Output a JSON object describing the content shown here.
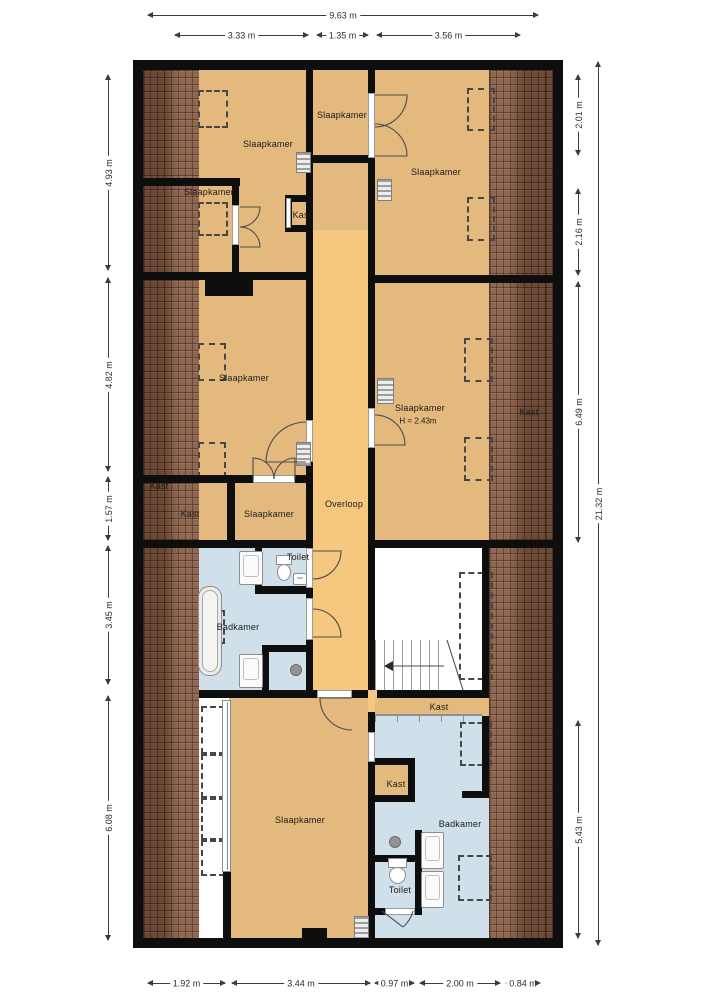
{
  "palette": {
    "wall": "#0e0e0e",
    "floor": "#e3b97d",
    "hallway": "#f6c77e",
    "bathroom": "#cfe0ea",
    "roof_tiles": "#8a6049",
    "background": "#ffffff"
  },
  "rooms": {
    "slaapkamer_top_left": "Slaapkamer",
    "slaapkamer_top_mid": "Slaapkamer",
    "slaapkamer_left": "Slaapkamer",
    "kast_top": "Kast",
    "slaapkamer_top_right": "Slaapkamer",
    "slaapkamer_mid_left": "Slaapkamer",
    "slaapkamer_mid_right": "Slaapkamer",
    "slaapkamer_mid_right_height": "H = 2.43m",
    "kast_roof_right": "Kast",
    "kast_roof_left": "Kast",
    "kast_mid_left": "Kast",
    "slaapkamer_small": "Slaapkamer",
    "overloop": "Overloop",
    "toilet_mid": "Toilet",
    "badkamer_mid": "Badkamer",
    "slaapkamer_bottom": "Slaapkamer",
    "kast_bottom_strip": "Kast",
    "kast_bottom_small": "Kast",
    "badkamer_bottom": "Badkamer",
    "toilet_bottom": "Toilet"
  },
  "dims": {
    "top_total": "9.63 m",
    "top": [
      "3.33 m",
      "1.35 m",
      "3.56 m"
    ],
    "left": [
      "4.93 m",
      "4.82 m",
      "1.57 m",
      "3.45 m",
      "6.08 m"
    ],
    "right": [
      "2.01 m",
      "2.16 m",
      "6.49 m",
      "5.43 m"
    ],
    "right_total": "21.32 m",
    "bottom": [
      "1.92 m",
      "3.44 m",
      "0.97 m",
      "2.00 m",
      "0.84 m"
    ]
  }
}
